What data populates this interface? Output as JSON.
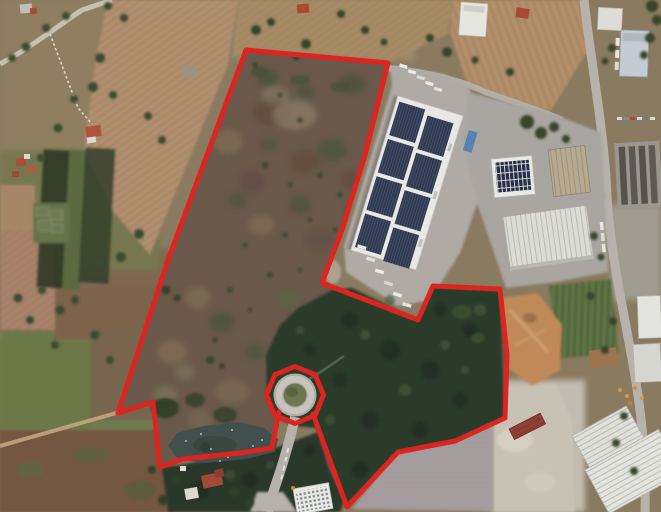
{
  "scene": {
    "type": "satellite-imagery",
    "description": "Aerial satellite view of a rural-industrial site: scrubland, woodland, a pond and a roundabout enclosed by a red land-parcel boundary, beside a large solar-roofed warehouse complex, farmland to the west and industrial yards to the east",
    "width": 661,
    "height": 512
  },
  "palette": {
    "boundary_red": "#dc2420",
    "scrub_brown": "#6a584a",
    "forest_green": "#2c3b2b",
    "field_tan": "#b19070",
    "water_dark": "#41504d",
    "road_gray": "#b7b3ac",
    "concrete_gray": "#afaba4",
    "roof_white": "#e8e8e4",
    "solar_panel_navy": "#2f3850",
    "quarry_orange": "#bf8a59",
    "parking_mauve": "#a59c9e"
  },
  "boundary": {
    "stroke_color": "#dc2420",
    "stroke_width": 5,
    "path": "M246,50 L388,63 L365,155 L342,230 L322,283 L418,320 L433,286 L500,289 L507,355 L505,418 L455,441 L398,452 L347,507 L313,414 M279,412 L272,448 L240,453 L183,459 L160,467 L153,402 L118,413 L168,260 L246,50",
    "ring_points": "295,366.5 315.2,374.8 323.5,395 315.2,415.2 295,423.5 274.8,415.2 266.5,395 274.8,374.8"
  },
  "landmarks": {
    "solar_warehouse": {
      "label": "warehouse with rooftop solar panels"
    },
    "pond": {
      "label": "pond",
      "outline": "168,446 177,433 204,426 238,422 264,428 278,439 275,452 246,459 205,463 178,459"
    },
    "roundabout": {
      "label": "roundabout",
      "cx": 295,
      "cy": 395
    },
    "access_road": {
      "label": "access road from roundabout",
      "path": "M295,417 C290,440 284,460 278,478 C273,492 270,502 268,512"
    },
    "main_road": {
      "label": "main road",
      "path": "M584,0 C592,70 604,130 607,195 C610,255 625,315 636,382 C643,425 646,470 645,512"
    },
    "country_road": {
      "label": "country road",
      "path": "M0,64 C30,48 55,28 82,10 L112,0"
    },
    "dirt_track": {
      "label": "dirt track",
      "path": "M0,446 L120,412"
    },
    "woodland": {
      "label": "dense woodland"
    },
    "scrubland": {
      "label": "scrub and fallow land inside boundary"
    },
    "farmland": {
      "label": "plowed fields and farmland"
    },
    "quarry": {
      "label": "excavated earth and gravel yard"
    },
    "greenhouses": {
      "label": "greenhouses"
    }
  }
}
